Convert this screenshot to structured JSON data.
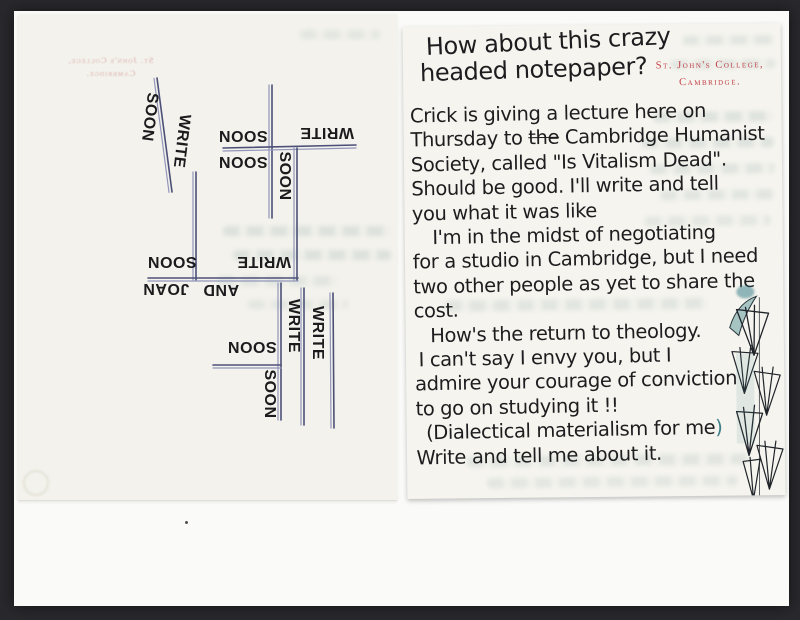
{
  "letterhead": {
    "line1": "St. John's College,",
    "line2": "Cambridge.",
    "color": "#c04048"
  },
  "letter": {
    "intro_line1": "How about this crazy",
    "intro_line2": "headed notepaper?",
    "body": [
      {
        "text": "Crick is giving a lecture here on"
      },
      {
        "pre": "Thursday to ",
        "strike": "the",
        "post": " Cambridge Humanist"
      },
      {
        "text": "Society, called \"Is Vitalism Dead\"."
      },
      {
        "text": "Should be good. I'll write and tell"
      },
      {
        "text": "you what it was like"
      },
      {
        "text": "I'm in the midst of negotiating",
        "indent": 20
      },
      {
        "text": "for a studio in Cambridge, but I need"
      },
      {
        "text": "two other people as yet to share the"
      },
      {
        "text": "cost."
      },
      {
        "text": "How's the return to theology.",
        "indent": 16
      },
      {
        "text": "I can't say I envy you, but I",
        "indent": 4
      },
      {
        "text": "admire your courage of conviction"
      },
      {
        "text": "to go on studying it !!"
      },
      {
        "text": "(Dialectical materialism for me",
        "teal_paren": ")",
        "indent": 10
      },
      {
        "text": "Write and tell me about it."
      }
    ]
  },
  "doodle": {
    "ink_color": "#4c5078",
    "ink_color_light": "#9296ba",
    "word_color": "#1b1b1d",
    "words": [
      {
        "text": "SOON",
        "x": 131,
        "y": 103,
        "rot": 97
      },
      {
        "text": "WRITE",
        "x": 163,
        "y": 127,
        "rot": 97
      },
      {
        "text": "SOON",
        "x": 225,
        "y": 121,
        "rot": 180
      },
      {
        "text": "WRITE",
        "x": 309,
        "y": 118,
        "rot": 180
      },
      {
        "text": "SOON",
        "x": 225,
        "y": 147,
        "rot": 180
      },
      {
        "text": "SOON",
        "x": 266,
        "y": 162,
        "rot": 90
      },
      {
        "text": "SOON",
        "x": 154,
        "y": 247,
        "rot": 180
      },
      {
        "text": "WRITE",
        "x": 246,
        "y": 247,
        "rot": 180
      },
      {
        "text": "JOAN",
        "x": 148,
        "y": 274,
        "rot": 180
      },
      {
        "text": "AND",
        "x": 203,
        "y": 275,
        "rot": 180
      },
      {
        "text": "WRITE",
        "x": 275,
        "y": 312,
        "rot": 90
      },
      {
        "text": "WRITE",
        "x": 299,
        "y": 319,
        "rot": 90
      },
      {
        "text": "SOON",
        "x": 234,
        "y": 332,
        "rot": 180
      },
      {
        "text": "SOON",
        "x": 251,
        "y": 380,
        "rot": 90
      }
    ],
    "lines": [
      {
        "x1": 139,
        "y1": 64,
        "x2": 154,
        "y2": 178
      },
      {
        "x1": 254,
        "y1": 71,
        "x2": 254,
        "y2": 204
      },
      {
        "x1": 205,
        "y1": 134,
        "x2": 338,
        "y2": 131
      },
      {
        "x1": 279,
        "y1": 134,
        "x2": 279,
        "y2": 266
      },
      {
        "x1": 178,
        "y1": 158,
        "x2": 178,
        "y2": 266
      },
      {
        "x1": 130,
        "y1": 264,
        "x2": 280,
        "y2": 264
      },
      {
        "x1": 263,
        "y1": 269,
        "x2": 263,
        "y2": 406
      },
      {
        "x1": 286,
        "y1": 274,
        "x2": 286,
        "y2": 411
      },
      {
        "x1": 315,
        "y1": 279,
        "x2": 316,
        "y2": 414
      },
      {
        "x1": 195,
        "y1": 351,
        "x2": 263,
        "y2": 351
      }
    ]
  }
}
